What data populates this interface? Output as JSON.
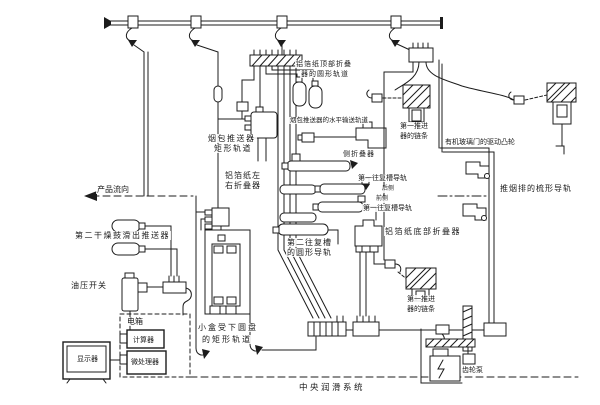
{
  "diagram": {
    "caption": "中央润滑系统",
    "colors": {
      "ink": "#1c1c1c",
      "paper": "#ffffff"
    },
    "labels": {
      "product_flow": "产品流向",
      "dryer_pusher": "第二干燥鼓滑出推送器",
      "oil_pressure_switch": "油压开关",
      "electric_box": "电箱",
      "computer": "计算器",
      "microprocessor": "微处理器",
      "display": "显示器",
      "small_box_rail_1": "小盒受下圆盘",
      "small_box_rail_2": "的矩形轨道",
      "pack_pusher_rail_1": "烟包推送器",
      "pack_pusher_rail_2": "矩形轨道",
      "foil_lr_folder_1": "铝箔纸左",
      "foil_lr_folder_2": "右折叠器",
      "foil_top_folder_1": "铝箔纸顶部折叠",
      "foil_top_folder_2": "器的圆形轨道",
      "horizontal_conveyor": "烟包推送器的水平输送轨道",
      "side_folder": "侧折叠器",
      "recip_rail_rear": "第一往复槽导轨",
      "rear_side": "后侧",
      "front_side": "前侧",
      "recip_rail_front": "第一往复槽导轨",
      "foil_bottom_folder": "铝箔纸底部折叠器",
      "second_recip_1": "第二往复槽",
      "second_recip_2": "的圆形导轨",
      "pusher_chain_top_1": "第一推进",
      "pusher_chain_top_2": "器的链条",
      "door_cam": "有机玻璃门的驱动凸轮",
      "comb_rail": "推烟排的梳形导轨",
      "pusher_chain_bottom_1": "第一推进",
      "pusher_chain_bottom_2": "器的链条",
      "gear_pump": "齿轮泵"
    }
  }
}
